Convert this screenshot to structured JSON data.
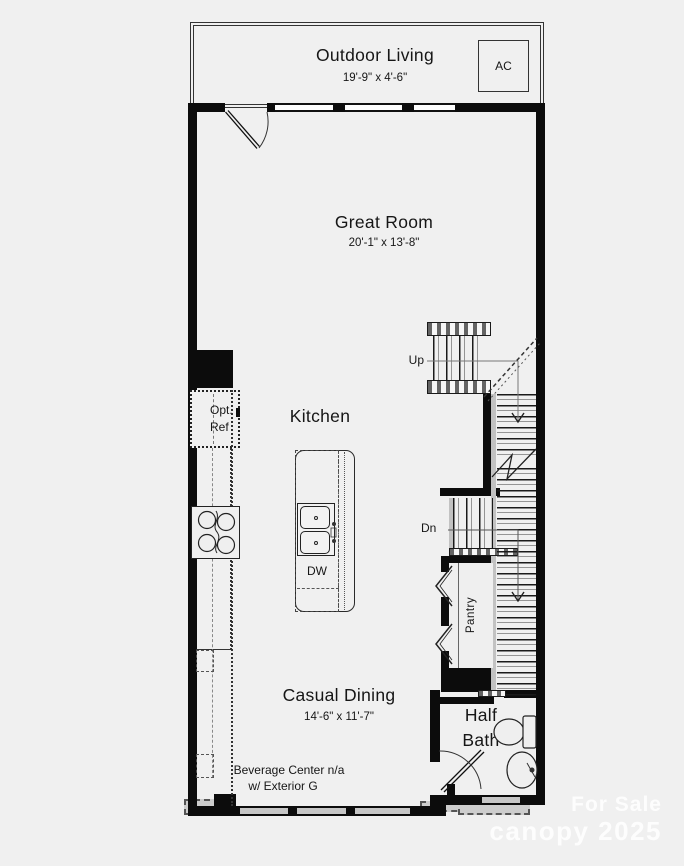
{
  "rooms": {
    "outdoor_living": {
      "name": "Outdoor Living",
      "dims": "19'-9\" x 4'-6\""
    },
    "great_room": {
      "name": "Great Room",
      "dims": "20'-1\" x 13'-8\""
    },
    "kitchen": {
      "name": "Kitchen"
    },
    "casual_dining": {
      "name": "Casual Dining",
      "dims": "14'-6\" x 11'-7\""
    },
    "half_bath": {
      "name_line1": "Half",
      "name_line2": "Bath"
    },
    "pantry": {
      "name": "Pantry"
    }
  },
  "labels": {
    "ac": "AC",
    "up": "Up",
    "dn": "Dn",
    "dw": "DW",
    "opt_ref_line1": "Opt.",
    "opt_ref_line2": "Ref",
    "note_line1": "Beverage Center n/a",
    "note_line2": "w/ Exterior G"
  },
  "watermark": {
    "line1": "For Sale",
    "line2": "canopy 2025"
  },
  "colors": {
    "wall": "#0c0c0c",
    "background": "#f0f0f0",
    "window_gray": "#c6c6c6",
    "watermark": "rgba(255,255,255,0.85)"
  }
}
